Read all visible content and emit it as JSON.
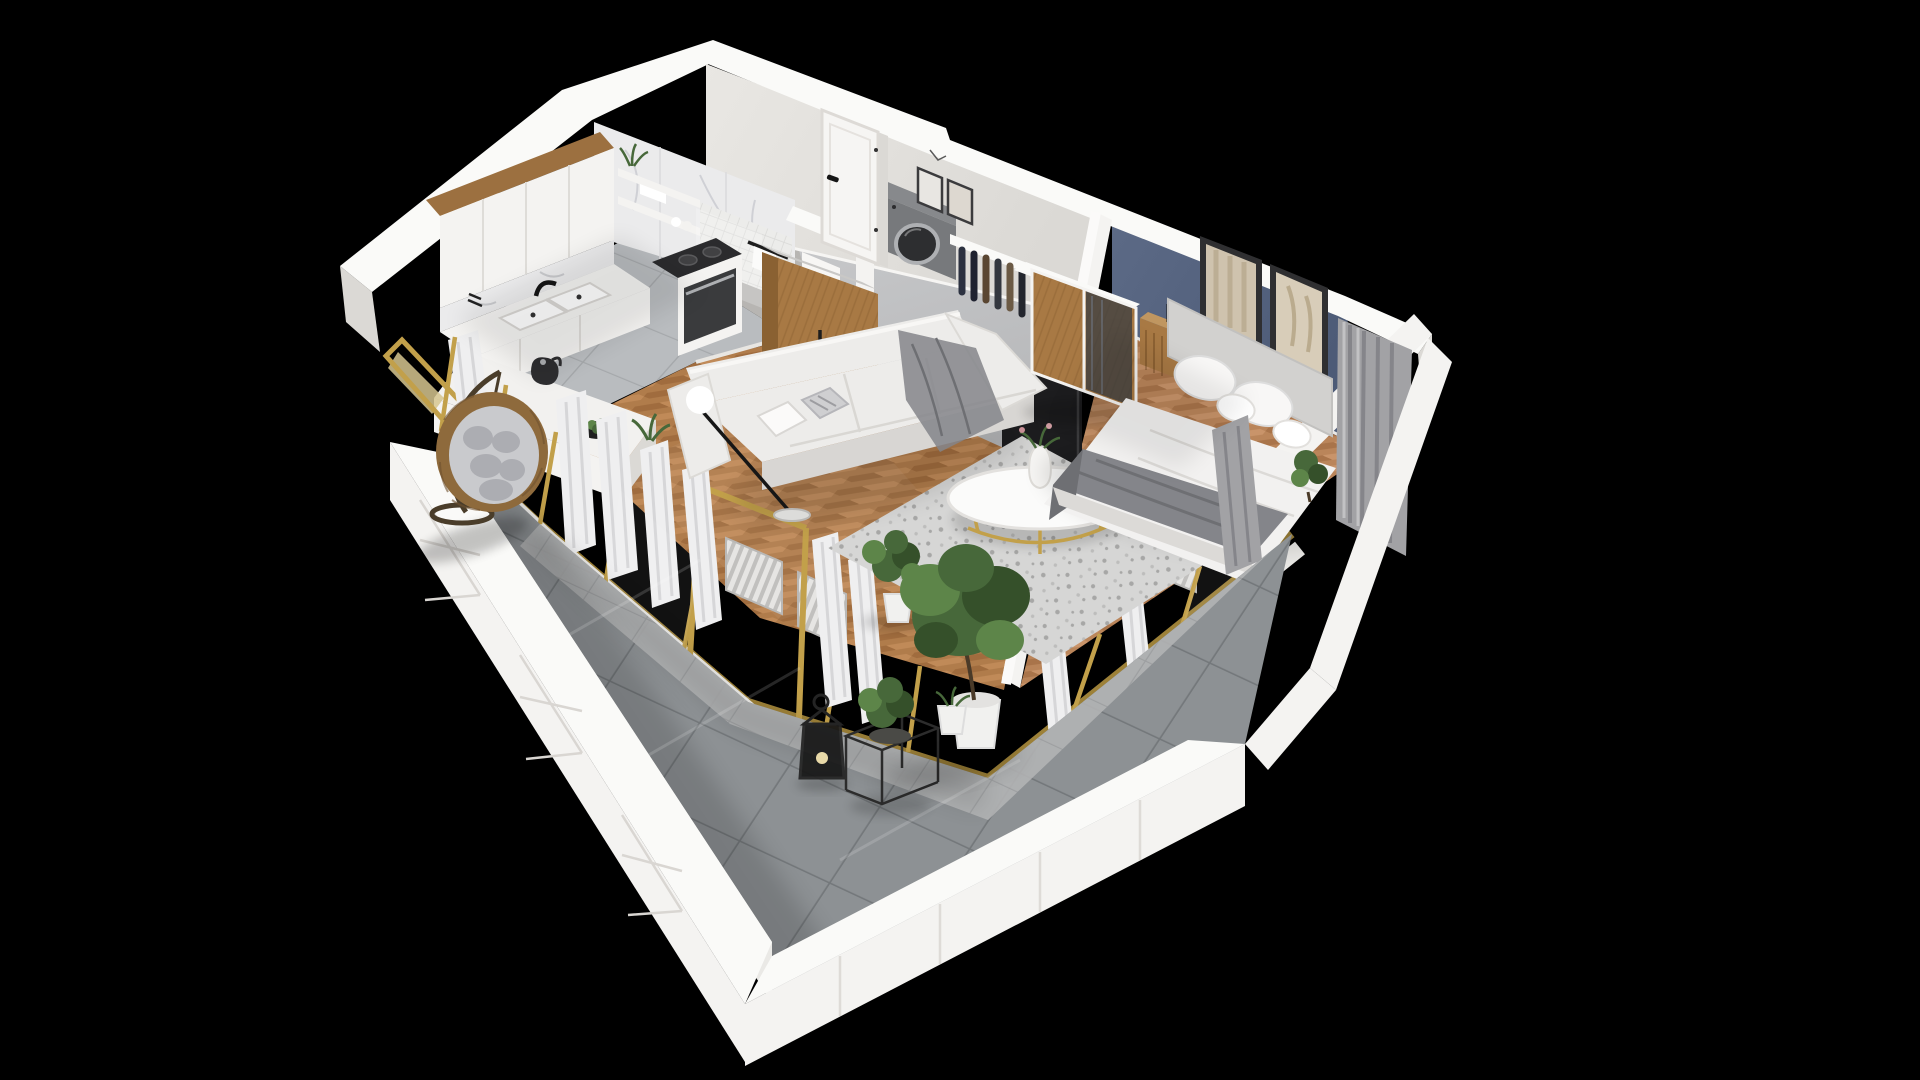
{
  "scene": {
    "title": "3D cutaway floor plan of a one-bedroom apartment with wrap-around balcony",
    "description": "Isometric dollhouse render on a black background: kitchen with wood-trimmed white cabinets, marble bathroom with washing machine, entry hallway, living room with white sofa and round coffee table on a speckled rug, bedroom with blue accent wall and double bed, and a large gray-tiled balcony with a hanging rattan egg chair, candle lantern and potted plants behind a gold-framed window wall.",
    "projection": "isometric cutaway",
    "background": "black",
    "rooms": [
      {
        "id": "kitchen",
        "label": "Kitchen",
        "floor": "gray ceramic tile",
        "items": [
          "upper cabinets with wood trim",
          "marble backsplash",
          "double sink",
          "black faucet",
          "cooktop and oven",
          "tall wood cabinet",
          "window counter with kettle and fruit bowl",
          "small plant"
        ]
      },
      {
        "id": "bathroom",
        "label": "Bathroom",
        "floor": "gray tile",
        "items": [
          "marble wall",
          "open shelves with towels",
          "shower",
          "washing machine",
          "toilet",
          "towel rail"
        ]
      },
      {
        "id": "hallway",
        "label": "Hallway",
        "floor": "concrete",
        "items": [
          "entrance door",
          "gallery picture frames"
        ]
      },
      {
        "id": "living-room",
        "label": "Living room",
        "floor": "herringbone oak",
        "items": [
          "white sofa with gray throw and pillows",
          "floor lamp with white globe",
          "round coffee table with flower vase",
          "speckled rug",
          "wall-mounted TV",
          "potted plant",
          "window radiators",
          "open bedroom door"
        ]
      },
      {
        "id": "bedroom",
        "label": "Bedroom",
        "floor": "herringbone oak",
        "items": [
          "blue accent wall",
          "two framed artworks",
          "double bed with white duvet and gray runner",
          "upholstered headboard",
          "four pillows",
          "wood nightstand with reading lamp",
          "open clothes rail with garments",
          "smoked-glass wood wardrobe",
          "corner gray curtains",
          "window radiator",
          "plant by the window"
        ]
      },
      {
        "id": "balcony",
        "label": "Balcony",
        "floor": "large gray tiles",
        "items": [
          "white panelled parapet",
          "hanging rattan egg chair with gray cushions",
          "black candle lantern",
          "wire cube side table with plant",
          "potted tree in white planter",
          "small white planter",
          "gold-framed window wall with sheer white curtains"
        ]
      }
    ]
  },
  "palette": {
    "bg": "#000000",
    "cap": "#fafaf8",
    "wall_bright": "#f4f3f1",
    "wall_light": "#eae9e6",
    "wall_mid": "#dbd9d5",
    "wall_shadow": "#c8c6c2",
    "wall_warm": "#e9e7e3",
    "blue_wall": "#5c6a86",
    "blue_wall_dark": "#4d5b77",
    "wood": "#a87944",
    "wood_dark": "#8a6132",
    "wood_light": "#c09660",
    "wood_trim": "#9c7040",
    "floor_wood": "#b07c4b",
    "floor_wood2": "#a06c3e",
    "floor_wood3": "#c08a58",
    "floor_woodb": "#ba855a",
    "floor_woodb2": "#a9744a",
    "floor_woodb3": "#c9946a",
    "tile_k": "#b9bcbf",
    "tile_k_grout": "#a5a8ab",
    "tile_b": "#8d9194",
    "tile_b_grout": "#74787b",
    "tile_b_light": "#b2b3b4",
    "concrete": "#b5b6b8",
    "marble": "#ebebec",
    "marble_vein": "#c9cad0",
    "gold": "#c2a04a",
    "gold_dark": "#9d8138",
    "gold_pale": "#d6c68f",
    "curt_w": "#efeff0",
    "curt_w_sh": "#d6d6d8",
    "curt_g": "#a2a2a5",
    "curt_g_dark": "#85858a",
    "sofa": "#edecea",
    "sofa_sh": "#d8d6d3",
    "bed": "#f2f1f0",
    "bed_sh": "#dcdad7",
    "headboard": "#d2d1cf",
    "blanket": "#84858a",
    "blanket_dark": "#6e6f73",
    "tv": "#1d1d1f",
    "appliance": "#77797c",
    "appliance_top": "#87898c",
    "appliance_dark": "#5b5d60",
    "appliance_door": "#2d2e30",
    "steel": "#aeb0b3",
    "plant_d": "#35502a",
    "plant_m": "#47683a",
    "plant_l": "#5d8549",
    "pot": "#f1f1ef",
    "rattan": "#8e6a3c",
    "rattan_dark": "#6f5230",
    "cushion": "#c9cacd",
    "cushion_dark": "#acadb2",
    "metal_black": "#232323",
    "radiator": "#e6e5e3",
    "rad_rib": "#c1c0be",
    "rug": "#d6d6d5",
    "rug_dot": "#a7a7a6",
    "rug_dot2": "#bdbdbc"
  }
}
